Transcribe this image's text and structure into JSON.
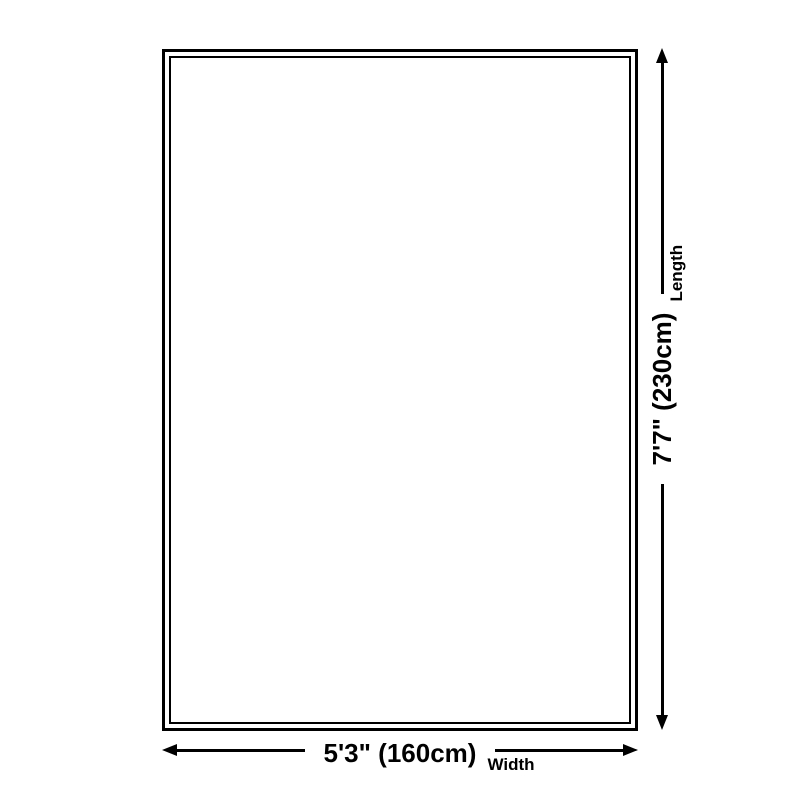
{
  "diagram": {
    "title": "rug size dimension diagram",
    "width_dimension": {
      "value": "5'3\" (160cm)",
      "caption": "Width"
    },
    "length_dimension": {
      "value": "7'7\" (230cm)",
      "caption": "Length"
    },
    "colors": {
      "line": "#000000",
      "background": "#ffffff"
    }
  }
}
